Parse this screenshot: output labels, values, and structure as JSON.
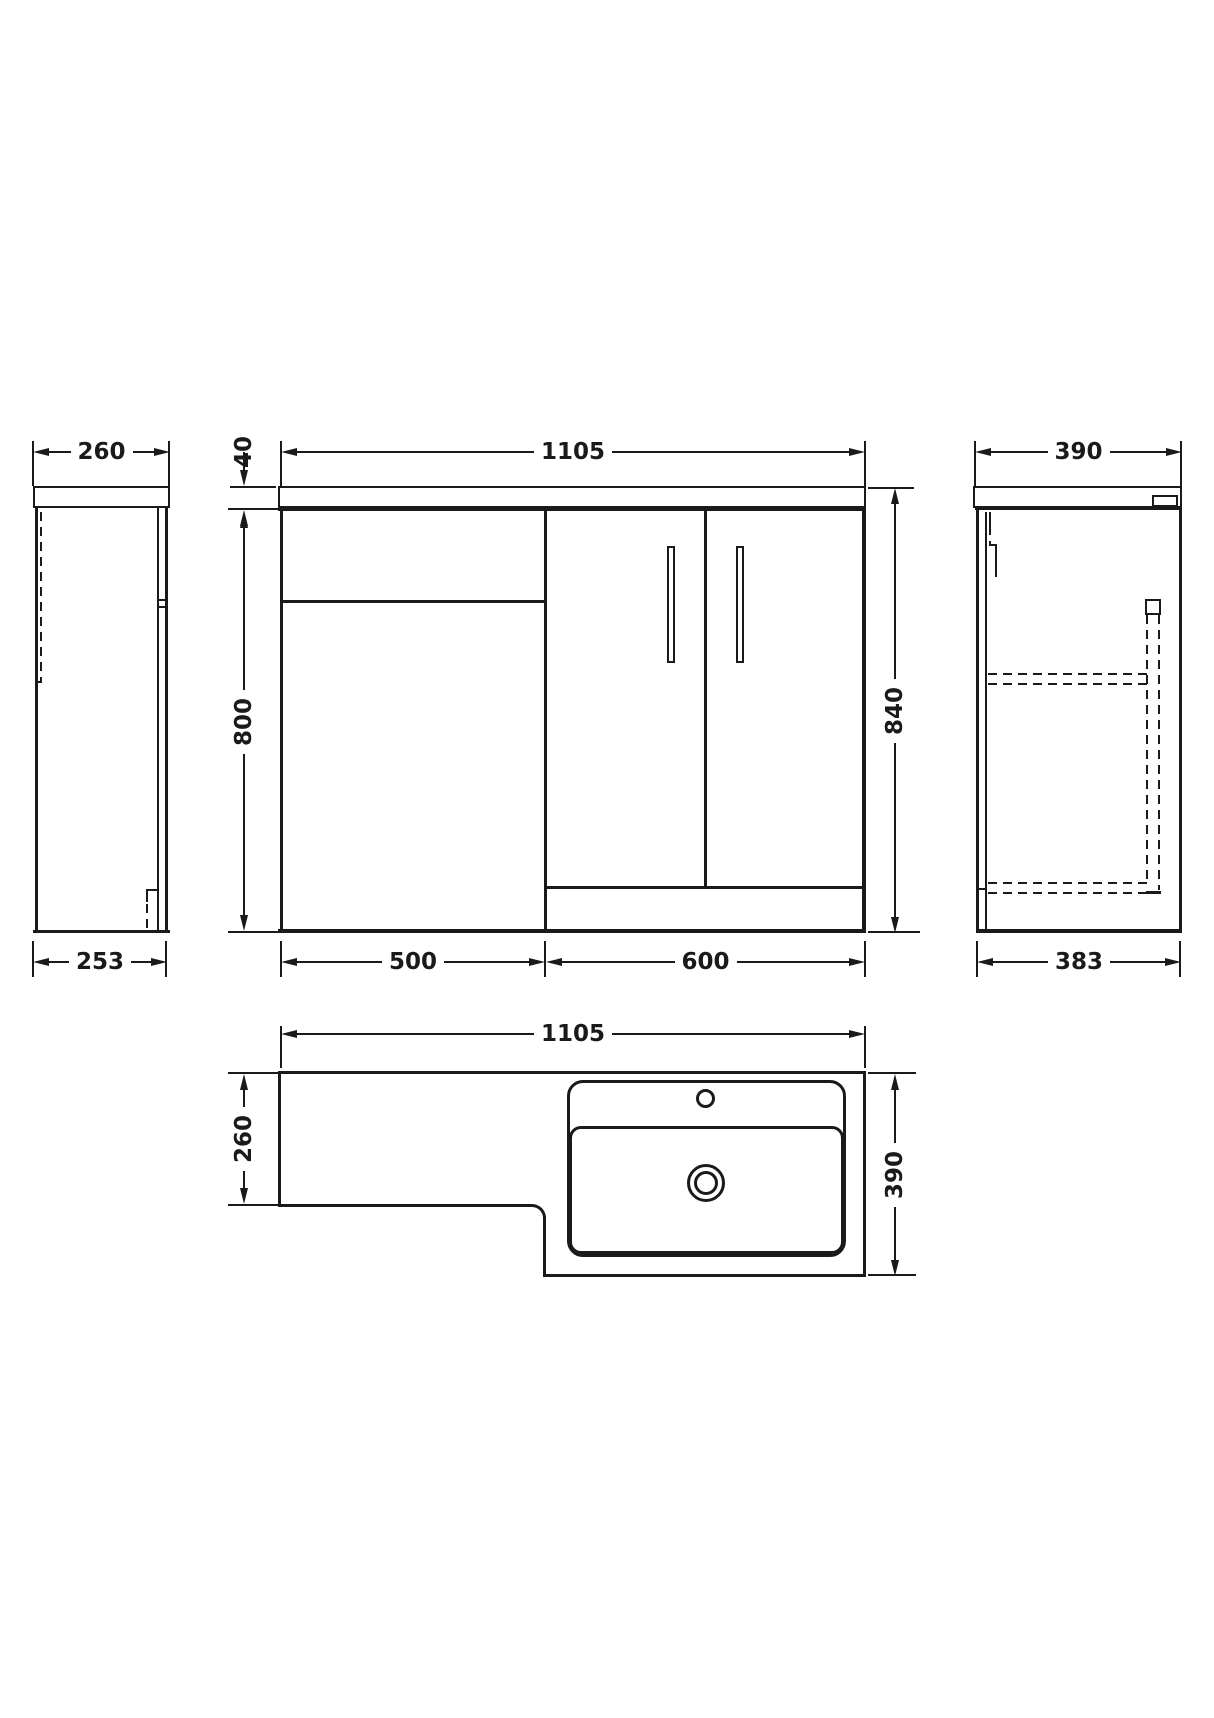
{
  "colors": {
    "line": "#1a1a1a",
    "background": "#ffffff"
  },
  "dims": {
    "left_top": "260",
    "left_bottom": "253",
    "front_width": "1105",
    "counter_thickness": "40",
    "cabinet_height": "800",
    "total_height": "840",
    "unit_left": "500",
    "unit_right": "600",
    "right_top": "390",
    "right_bottom": "383",
    "plan_width": "1105",
    "plan_left_depth": "260",
    "plan_right_depth": "390"
  }
}
